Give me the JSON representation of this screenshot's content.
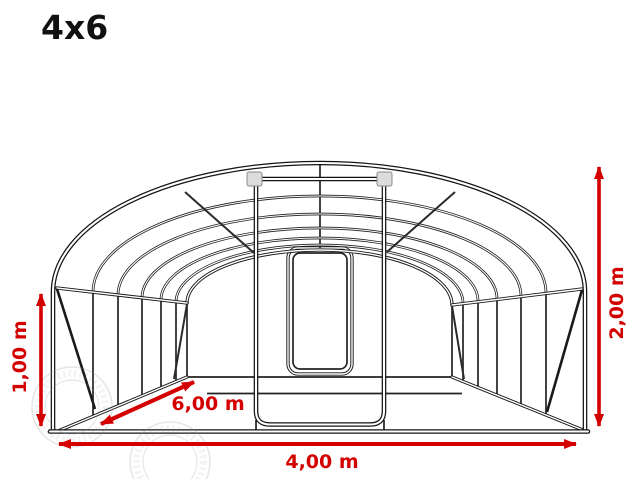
{
  "title": "4x6",
  "diagram": {
    "type": "greenhouse-polytunnel-front-perspective-drawing",
    "dimensions": {
      "side_height": {
        "label": "1,00 m",
        "value_m": 1.0,
        "position": "left-vertical"
      },
      "ridge_height": {
        "label": "2,00 m",
        "value_m": 2.0,
        "position": "right-vertical"
      },
      "length": {
        "label": "6,00 m",
        "value_m": 6.0,
        "position": "floor-diagonal"
      },
      "width": {
        "label": "4,00 m",
        "value_m": 4.0,
        "position": "bottom-horizontal"
      }
    },
    "colors": {
      "dimension": "#d40000",
      "structure": "#1a1a1a",
      "background": "#ffffff",
      "bracket_fill": "#dcdcdc"
    }
  }
}
